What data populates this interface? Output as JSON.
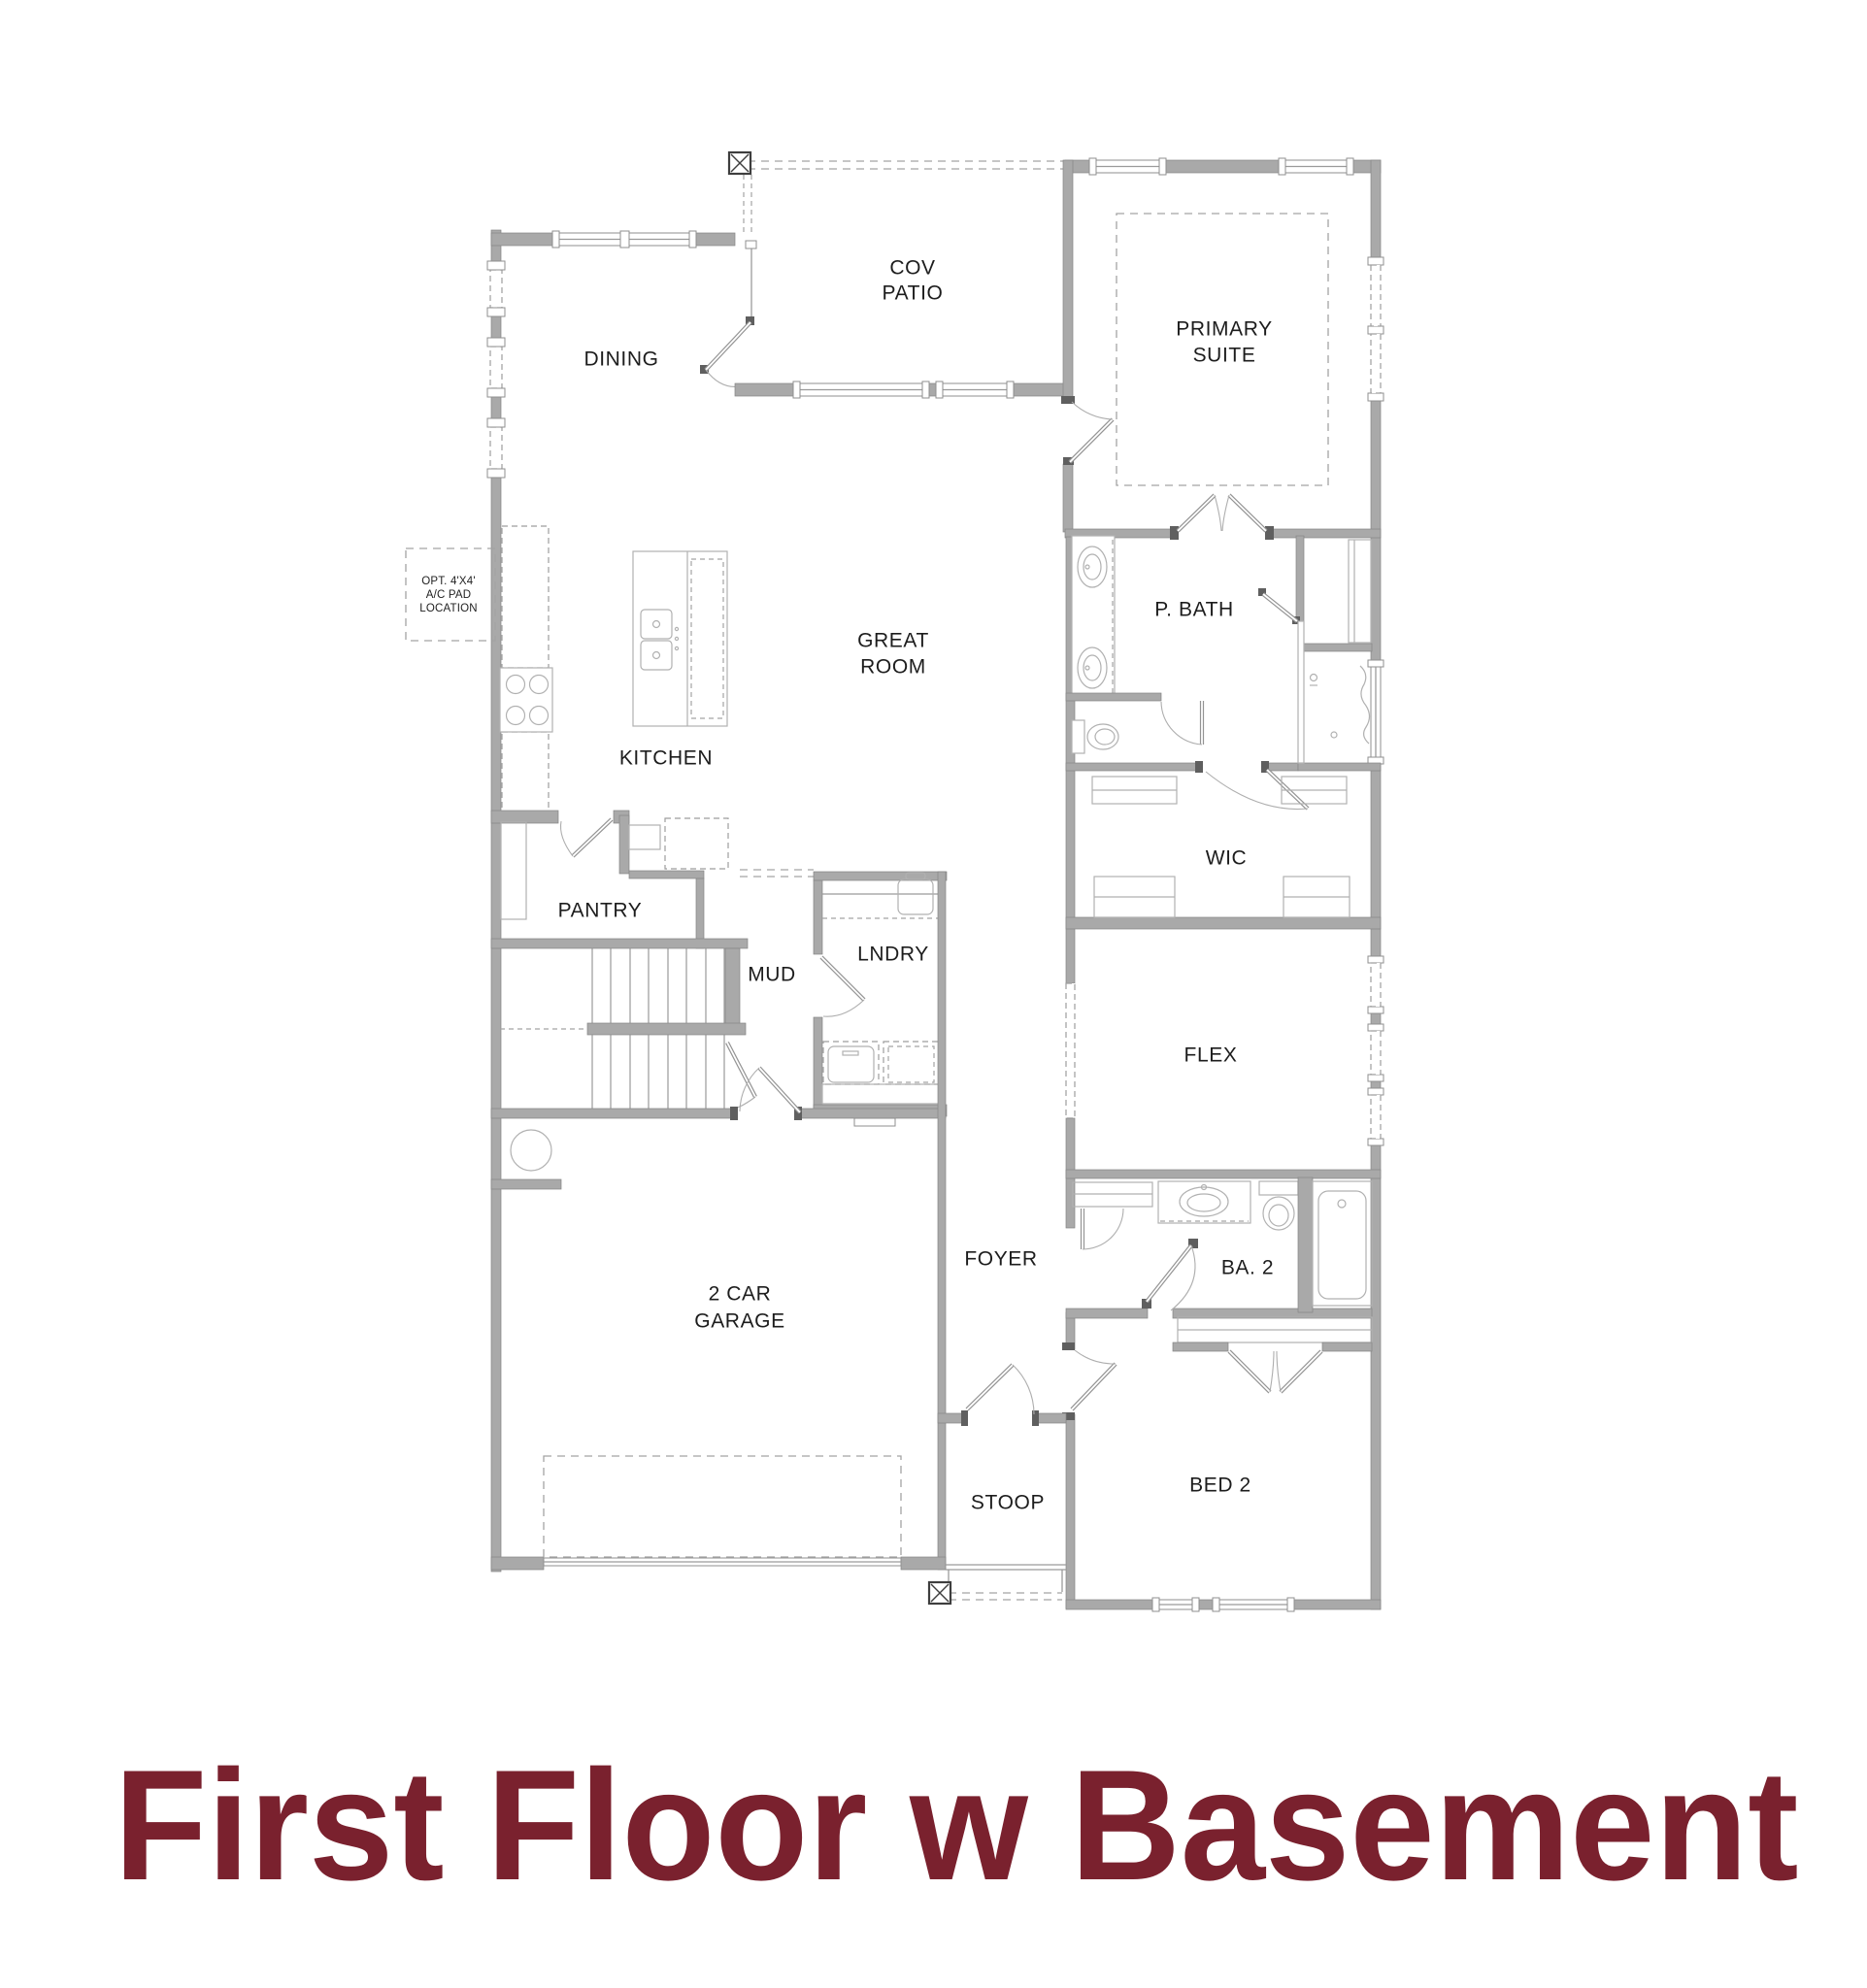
{
  "title": {
    "text": "First Floor w Basement",
    "color": "#7a212e"
  },
  "rooms": {
    "dining": "DINING",
    "cov_patio": {
      "line1": "COV",
      "line2": "PATIO"
    },
    "primary_suite": {
      "line1": "PRIMARY",
      "line2": "SUITE"
    },
    "great_room": {
      "line1": "GREAT",
      "line2": "ROOM"
    },
    "kitchen": "KITCHEN",
    "p_bath": "P. BATH",
    "wic": "WIC",
    "pantry": "PANTRY",
    "mud": "MUD",
    "lndry": "LNDRY",
    "flex": "FLEX",
    "garage": {
      "line1": "2 CAR",
      "line2": "GARAGE"
    },
    "foyer": "FOYER",
    "ba2": "BA. 2",
    "stoop": "STOOP",
    "bed2": "BED 2"
  },
  "notes": {
    "ac_pad": {
      "line1": "OPT. 4'X4'",
      "line2": "A/C PAD",
      "line3": "LOCATION"
    }
  },
  "colors": {
    "background": "#ffffff",
    "wall": "#a9a9a9",
    "line": "#9a9a9a",
    "label": "#1d1d1d",
    "title": "#7a212e"
  }
}
